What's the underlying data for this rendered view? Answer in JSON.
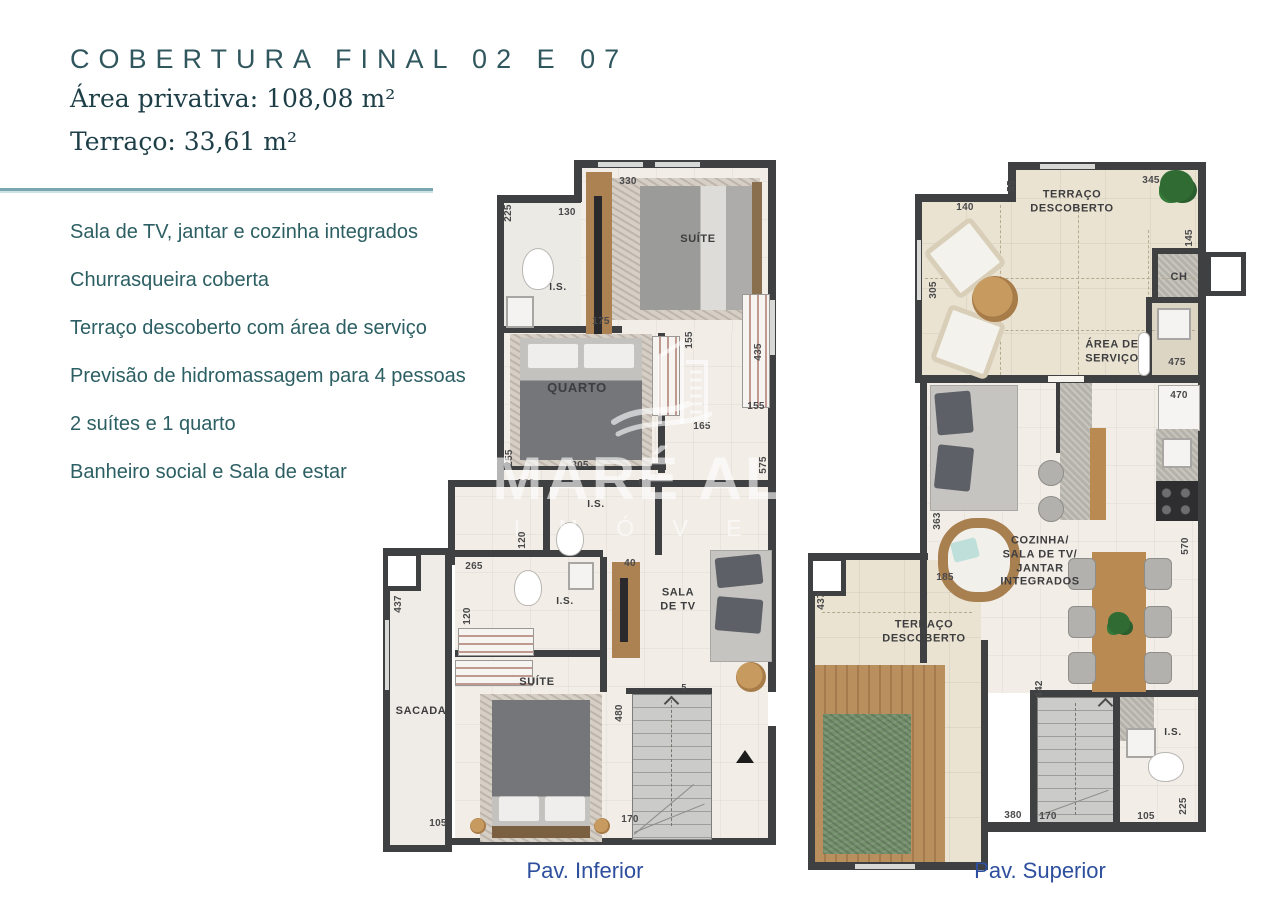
{
  "header": {
    "title": "COBERTURA FINAL 02 E 07",
    "area_privativa": "Área privativa: 108,08 m²",
    "terraco": "Terraço: 33,61 m²"
  },
  "features": [
    "Sala de TV, jantar e cozinha integrados",
    "Churrasqueira coberta",
    "Terraço descoberto com área de serviço",
    "Previsão de hidromassagem para 4 pessoas",
    "2 suítes e 1 quarto",
    "Banheiro social e Sala de estar"
  ],
  "watermark": {
    "brand": "MARÉ ALTA",
    "sub": "I M Ó V E I S"
  },
  "colors": {
    "accent_teal": "#31575e",
    "divider_teal": "#79a7b1",
    "caption_blue": "#2d4f9e",
    "wall_gray": "#3f4042",
    "terrace_beige": "#eae3d2",
    "pool_green": "#74906c"
  },
  "plans": {
    "inferior": {
      "caption": "Pav. Inferior",
      "rooms": [
        {
          "text": "SUÍTE",
          "x": 698,
          "y": 240
        },
        {
          "text": "I.S.",
          "x": 558,
          "y": 288,
          "size": 10
        },
        {
          "text": "QUARTO",
          "x": 577,
          "y": 388,
          "size": 13
        },
        {
          "text": "I.S.",
          "x": 596,
          "y": 505,
          "size": 10
        },
        {
          "text": "I.S.",
          "x": 565,
          "y": 602,
          "size": 10
        },
        {
          "text": "SALA\nDE TV",
          "x": 678,
          "y": 600
        },
        {
          "text": "SUÍTE",
          "x": 537,
          "y": 683
        },
        {
          "text": "SACADA",
          "x": 421,
          "y": 712
        }
      ],
      "dims": [
        {
          "text": "330",
          "x": 628,
          "y": 182
        },
        {
          "text": "130",
          "x": 567,
          "y": 213
        },
        {
          "text": "225",
          "x": 509,
          "y": 213,
          "rot": -90
        },
        {
          "text": "175",
          "x": 601,
          "y": 322
        },
        {
          "text": "155",
          "x": 690,
          "y": 340,
          "rot": -90
        },
        {
          "text": "435",
          "x": 759,
          "y": 352,
          "rot": -90
        },
        {
          "text": "155",
          "x": 756,
          "y": 407
        },
        {
          "text": "165",
          "x": 702,
          "y": 427
        },
        {
          "text": "305",
          "x": 580,
          "y": 466
        },
        {
          "text": "255",
          "x": 510,
          "y": 458,
          "rot": -90
        },
        {
          "text": "200",
          "x": 526,
          "y": 484
        },
        {
          "text": "90",
          "x": 644,
          "y": 484
        },
        {
          "text": "575",
          "x": 764,
          "y": 465,
          "rot": -90
        },
        {
          "text": "120",
          "x": 523,
          "y": 540,
          "rot": -90
        },
        {
          "text": "265",
          "x": 474,
          "y": 567
        },
        {
          "text": "40",
          "x": 630,
          "y": 564
        },
        {
          "text": "120",
          "x": 468,
          "y": 616,
          "rot": -90
        },
        {
          "text": "437",
          "x": 399,
          "y": 604,
          "rot": -90
        },
        {
          "text": "105",
          "x": 438,
          "y": 824
        },
        {
          "text": "480",
          "x": 620,
          "y": 713,
          "rot": -90
        },
        {
          "text": "5",
          "x": 684,
          "y": 688,
          "size": 9
        },
        {
          "text": "170",
          "x": 630,
          "y": 820
        }
      ]
    },
    "superior": {
      "caption": "Pav. Superior",
      "rooms": [
        {
          "text": "TERRAÇO\nDESCOBERTO",
          "x": 1072,
          "y": 202
        },
        {
          "text": "CH",
          "x": 1179,
          "y": 278
        },
        {
          "text": "ÁREA DE\nSERVIÇO",
          "x": 1112,
          "y": 352
        },
        {
          "text": "COZINHA/\nSALA DE TV/\nJANTAR\nINTEGRADOS",
          "x": 1040,
          "y": 562
        },
        {
          "text": "TERRAÇO\nDESCOBERTO",
          "x": 924,
          "y": 632
        },
        {
          "text": "I.S.",
          "x": 1173,
          "y": 733,
          "size": 10
        }
      ],
      "dims": [
        {
          "text": "140",
          "x": 965,
          "y": 208
        },
        {
          "text": "55",
          "x": 1012,
          "y": 186,
          "rot": -90
        },
        {
          "text": "345",
          "x": 1151,
          "y": 181
        },
        {
          "text": "145",
          "x": 1190,
          "y": 238,
          "rot": -90
        },
        {
          "text": "305",
          "x": 934,
          "y": 290,
          "rot": -90
        },
        {
          "text": "475",
          "x": 1177,
          "y": 363
        },
        {
          "text": "470",
          "x": 1179,
          "y": 396
        },
        {
          "text": "363",
          "x": 938,
          "y": 521,
          "rot": -90
        },
        {
          "text": "185",
          "x": 945,
          "y": 578
        },
        {
          "text": "570",
          "x": 1186,
          "y": 546,
          "rot": -90
        },
        {
          "text": "437",
          "x": 822,
          "y": 601,
          "rot": -90
        },
        {
          "text": "380",
          "x": 1013,
          "y": 816
        },
        {
          "text": "442",
          "x": 1040,
          "y": 689,
          "rot": -90
        },
        {
          "text": "170",
          "x": 1048,
          "y": 817
        },
        {
          "text": "105",
          "x": 1146,
          "y": 817
        },
        {
          "text": "225",
          "x": 1184,
          "y": 806,
          "rot": -90
        }
      ]
    }
  }
}
